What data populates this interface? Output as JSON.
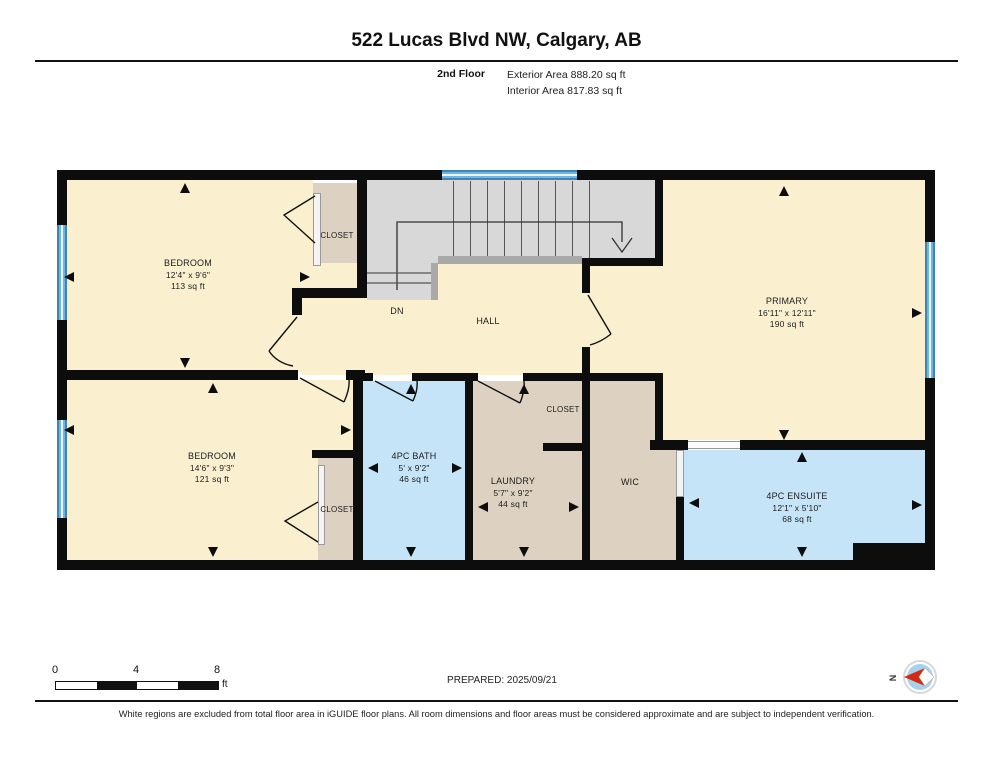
{
  "header": {
    "title": "522 Lucas Blvd NW, Calgary, AB",
    "floor_label": "2nd Floor",
    "exterior_area": "Exterior Area 888.20 sq ft",
    "interior_area": "Interior Area 817.83 sq ft"
  },
  "rooms": {
    "bedroom1": {
      "name": "BEDROOM",
      "dims": "12'4\" x 9'6\"",
      "area": "113 sq ft"
    },
    "closet1": {
      "name": "CLOSET"
    },
    "hall": {
      "name": "HALL"
    },
    "stairs_down": {
      "label": "DN"
    },
    "primary": {
      "name": "PRIMARY",
      "dims": "16'11\" x 12'11\"",
      "area": "190 sq ft"
    },
    "bedroom2": {
      "name": "BEDROOM",
      "dims": "14'6\" x 9'3\"",
      "area": "121 sq ft"
    },
    "closet2": {
      "name": "CLOSET"
    },
    "bath": {
      "name": "4PC BATH",
      "dims": "5' x 9'2\"",
      "area": "46 sq ft"
    },
    "laundry": {
      "name": "LAUNDRY",
      "dims": "5'7\" x 9'2\"",
      "area": "44 sq ft"
    },
    "laundry_closet": {
      "name": "CLOSET"
    },
    "wic": {
      "name": "WIC"
    },
    "ensuite": {
      "name": "4PC ENSUITE",
      "dims": "12'1\" x 5'10\"",
      "area": "68 sq ft"
    }
  },
  "scale_bar": {
    "ticks": [
      "0",
      "4",
      "8"
    ],
    "unit": "ft"
  },
  "compass": {
    "label": "N"
  },
  "footer": {
    "prepared": "PREPARED: 2025/09/21",
    "disclaimer": "White regions are excluded from total floor area in iGUIDE floor plans. All room dimensions and floor areas must be considered approximate and are subject to independent verification."
  },
  "colors": {
    "wall": "#0d0d0d",
    "room_fill": "#faf0d0",
    "closet_fill": "#ddd2c2",
    "wet_room_fill": "#c5e4f7",
    "stair_fill": "#d8d8d8",
    "window_blue": "#4f9fd3",
    "compass_red": "#d42a12",
    "compass_blue": "#a6d2ec"
  }
}
